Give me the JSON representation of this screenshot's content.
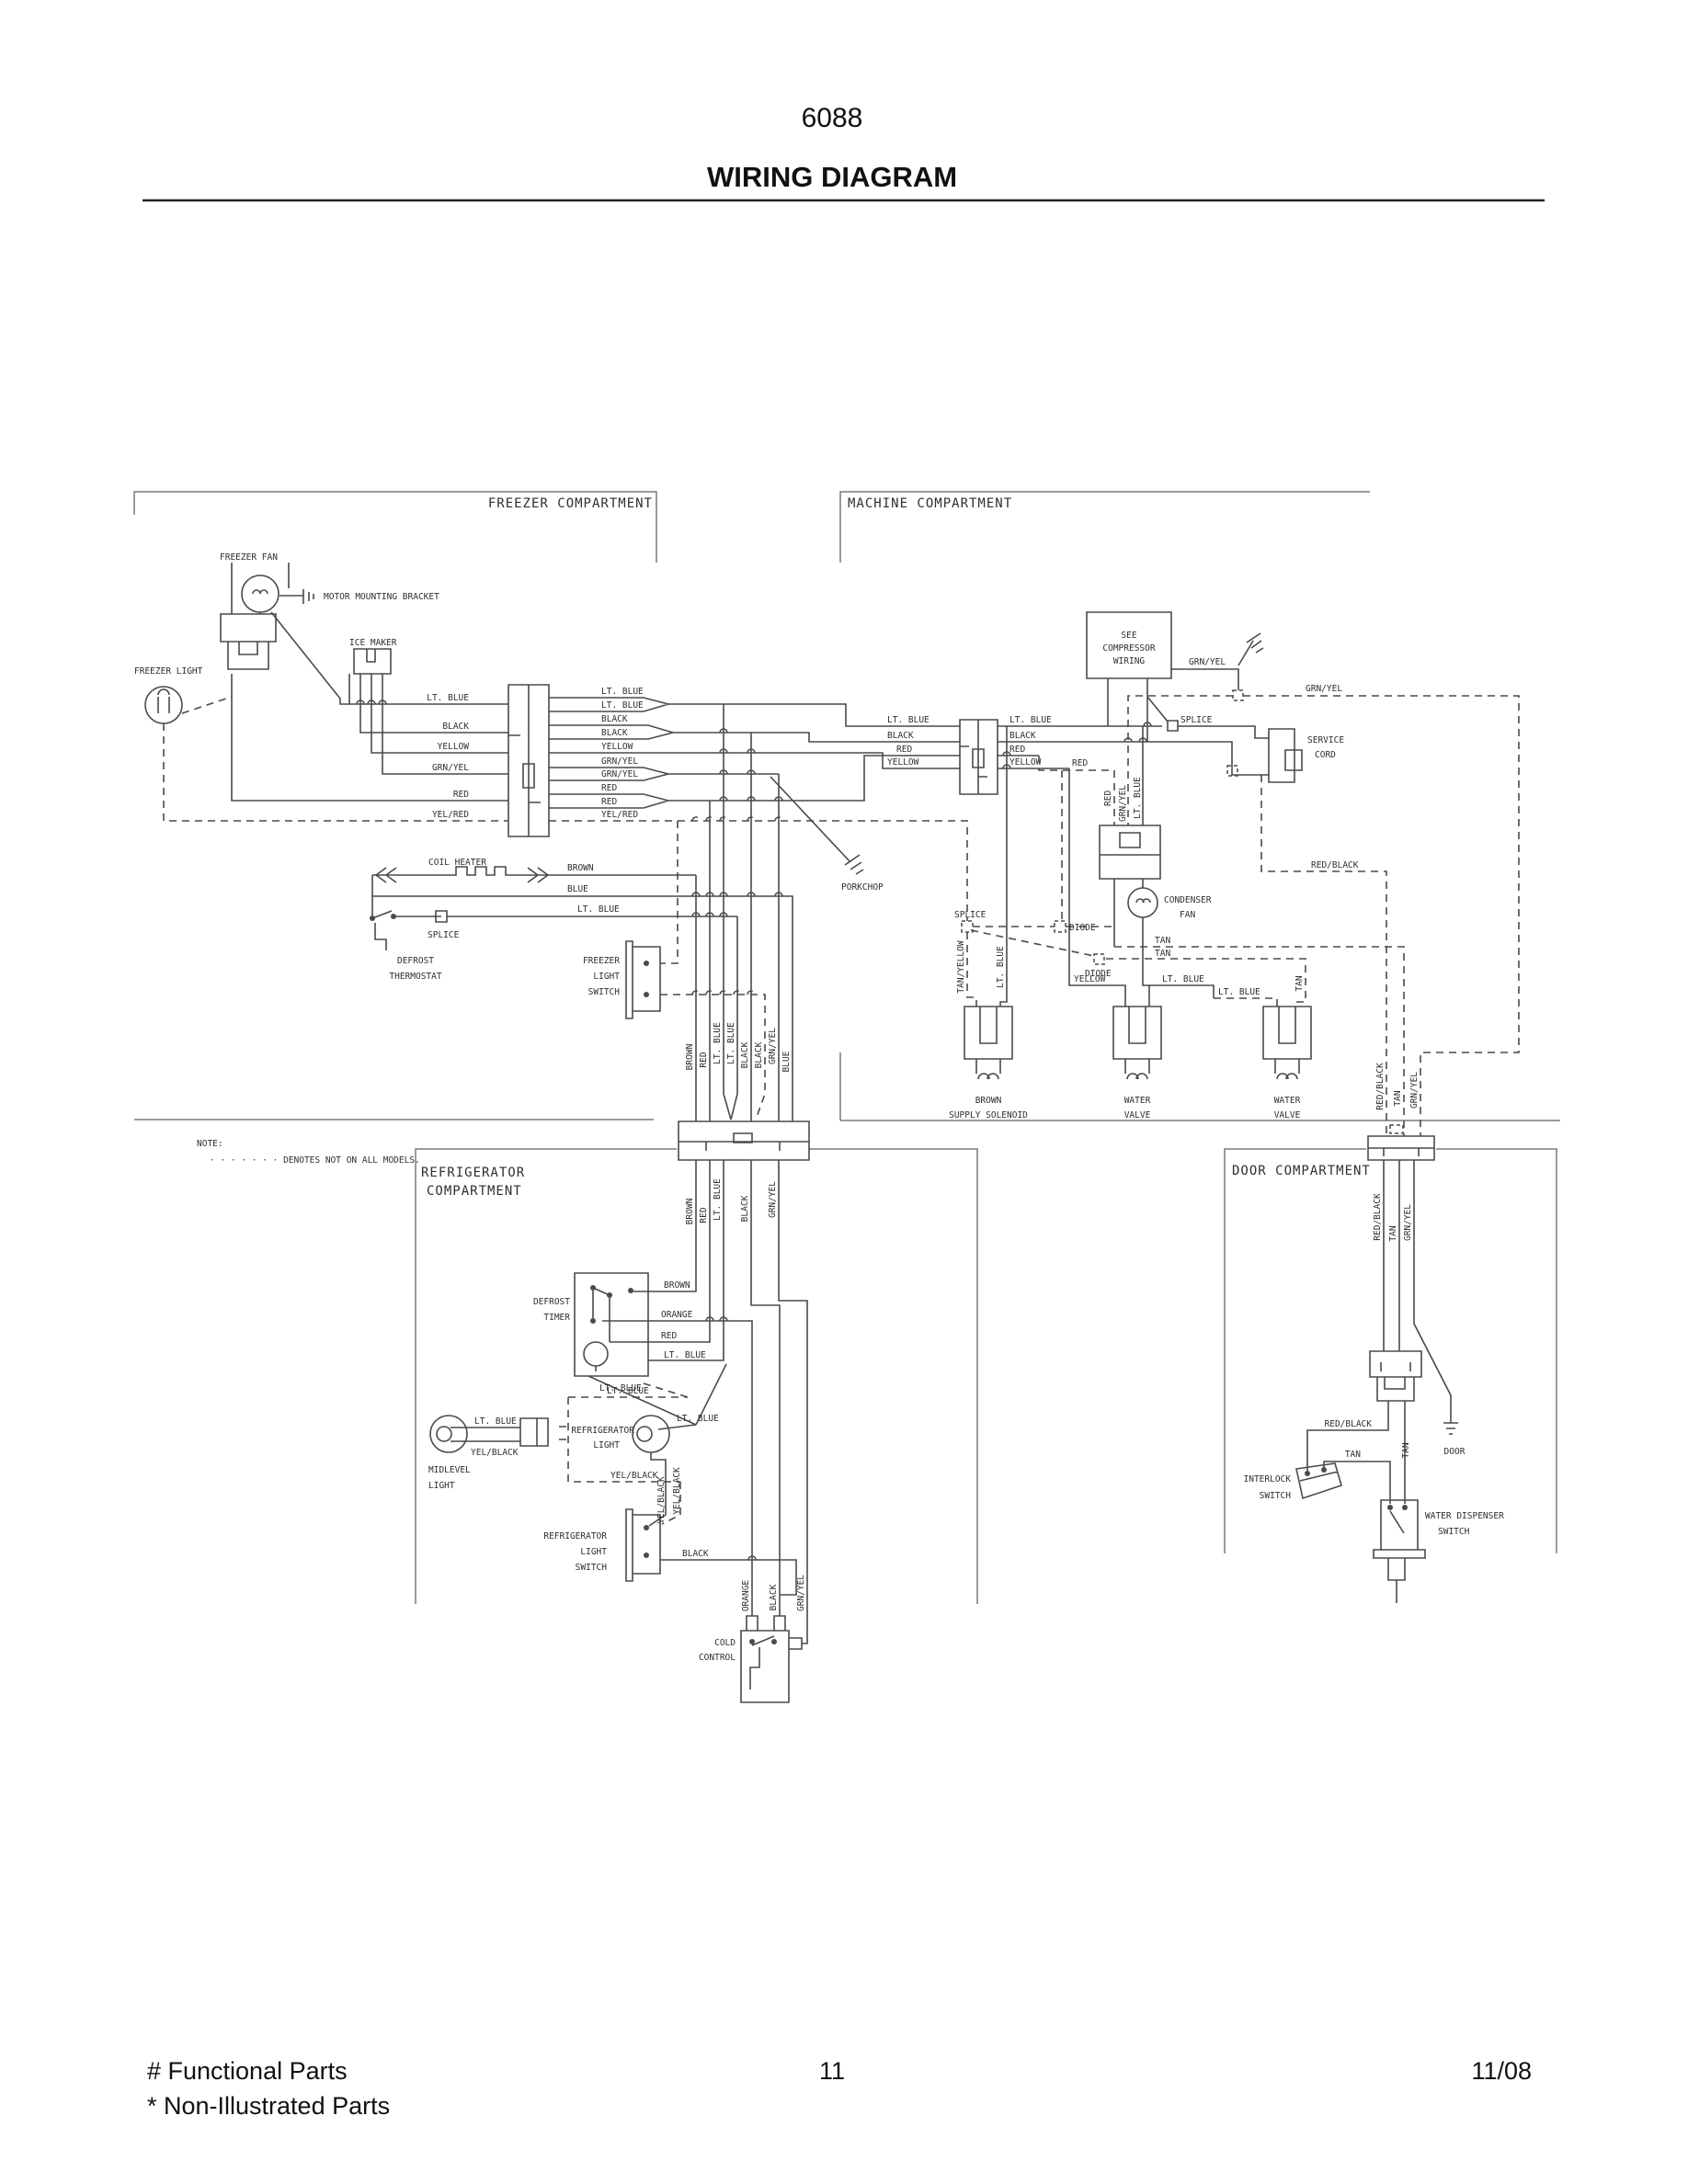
{
  "header": {
    "doc_number": "6088",
    "title": "WIRING DIAGRAM"
  },
  "compartments": {
    "freezer": "FREEZER COMPARTMENT",
    "machine": "MACHINE COMPARTMENT",
    "refrigerator_line1": "REFRIGERATOR",
    "refrigerator_line2": "COMPARTMENT",
    "door": "DOOR COMPARTMENT"
  },
  "note": {
    "heading": "NOTE:",
    "body": "· · · · · · · DENOTES NOT ON ALL MODELS."
  },
  "wire_colors": {
    "lt_blue": "LT. BLUE",
    "black": "BLACK",
    "yellow": "YELLOW",
    "grn_yel": "GRN/YEL",
    "red": "RED",
    "yel_red": "YEL/RED",
    "brown": "BROWN",
    "blue": "BLUE",
    "orange": "ORANGE",
    "tan": "TAN",
    "tan_yellow": "TAN/YELLOW",
    "red_black": "RED/BLACK",
    "yel_black": "YEL/BLACK"
  },
  "components": {
    "freezer_fan": "FREEZER FAN",
    "motor_mounting_bracket": "MOTOR MOUNTING BRACKET",
    "freezer_light": "FREEZER LIGHT",
    "ice_maker": "ICE MAKER",
    "coil_heater": "COIL HEATER",
    "splice": "SPLICE",
    "defrost_thermostat_1": "DEFROST",
    "defrost_thermostat_2": "THERMOSTAT",
    "freezer_light_switch_1": "FREEZER",
    "freezer_light_switch_2": "LIGHT",
    "freezer_light_switch_3": "SWITCH",
    "porkchop": "PORKCHOP",
    "compressor_1": "SEE",
    "compressor_2": "COMPRESSOR",
    "compressor_3": "WIRING",
    "service_cord_1": "SERVICE",
    "service_cord_2": "CORD",
    "condenser_fan_1": "CONDENSER",
    "condenser_fan_2": "FAN",
    "diode": "DIODE",
    "supply_solenoid_1": "BROWN",
    "supply_solenoid_2": "SUPPLY SOLENOID",
    "water_valve_1": "WATER",
    "water_valve_2": "VALVE",
    "defrost_timer_1": "DEFROST",
    "defrost_timer_2": "TIMER",
    "midlevel_light_1": "MIDLEVEL",
    "midlevel_light_2": "LIGHT",
    "refrigerator_light_1": "REFRIGERATOR",
    "refrigerator_light_2": "LIGHT",
    "refrigerator_light_switch_1": "REFRIGERATOR",
    "refrigerator_light_switch_2": "LIGHT",
    "refrigerator_light_switch_3": "SWITCH",
    "cold_control_1": "COLD",
    "cold_control_2": "CONTROL",
    "interlock_switch_1": "INTERLOCK",
    "interlock_switch_2": "SWITCH",
    "door": "DOOR",
    "water_dispenser_switch_1": "WATER DISPENSER",
    "water_dispenser_switch_2": "SWITCH"
  },
  "footer": {
    "functional_parts": "# Functional Parts",
    "non_illustrated_parts": "* Non-Illustrated Parts",
    "page_number": "11",
    "date": "11/08"
  },
  "colors": {
    "ink": "#2f2f2f",
    "wire": "#4a4a4a",
    "border": "#7a7a7a",
    "background": "#ffffff"
  }
}
